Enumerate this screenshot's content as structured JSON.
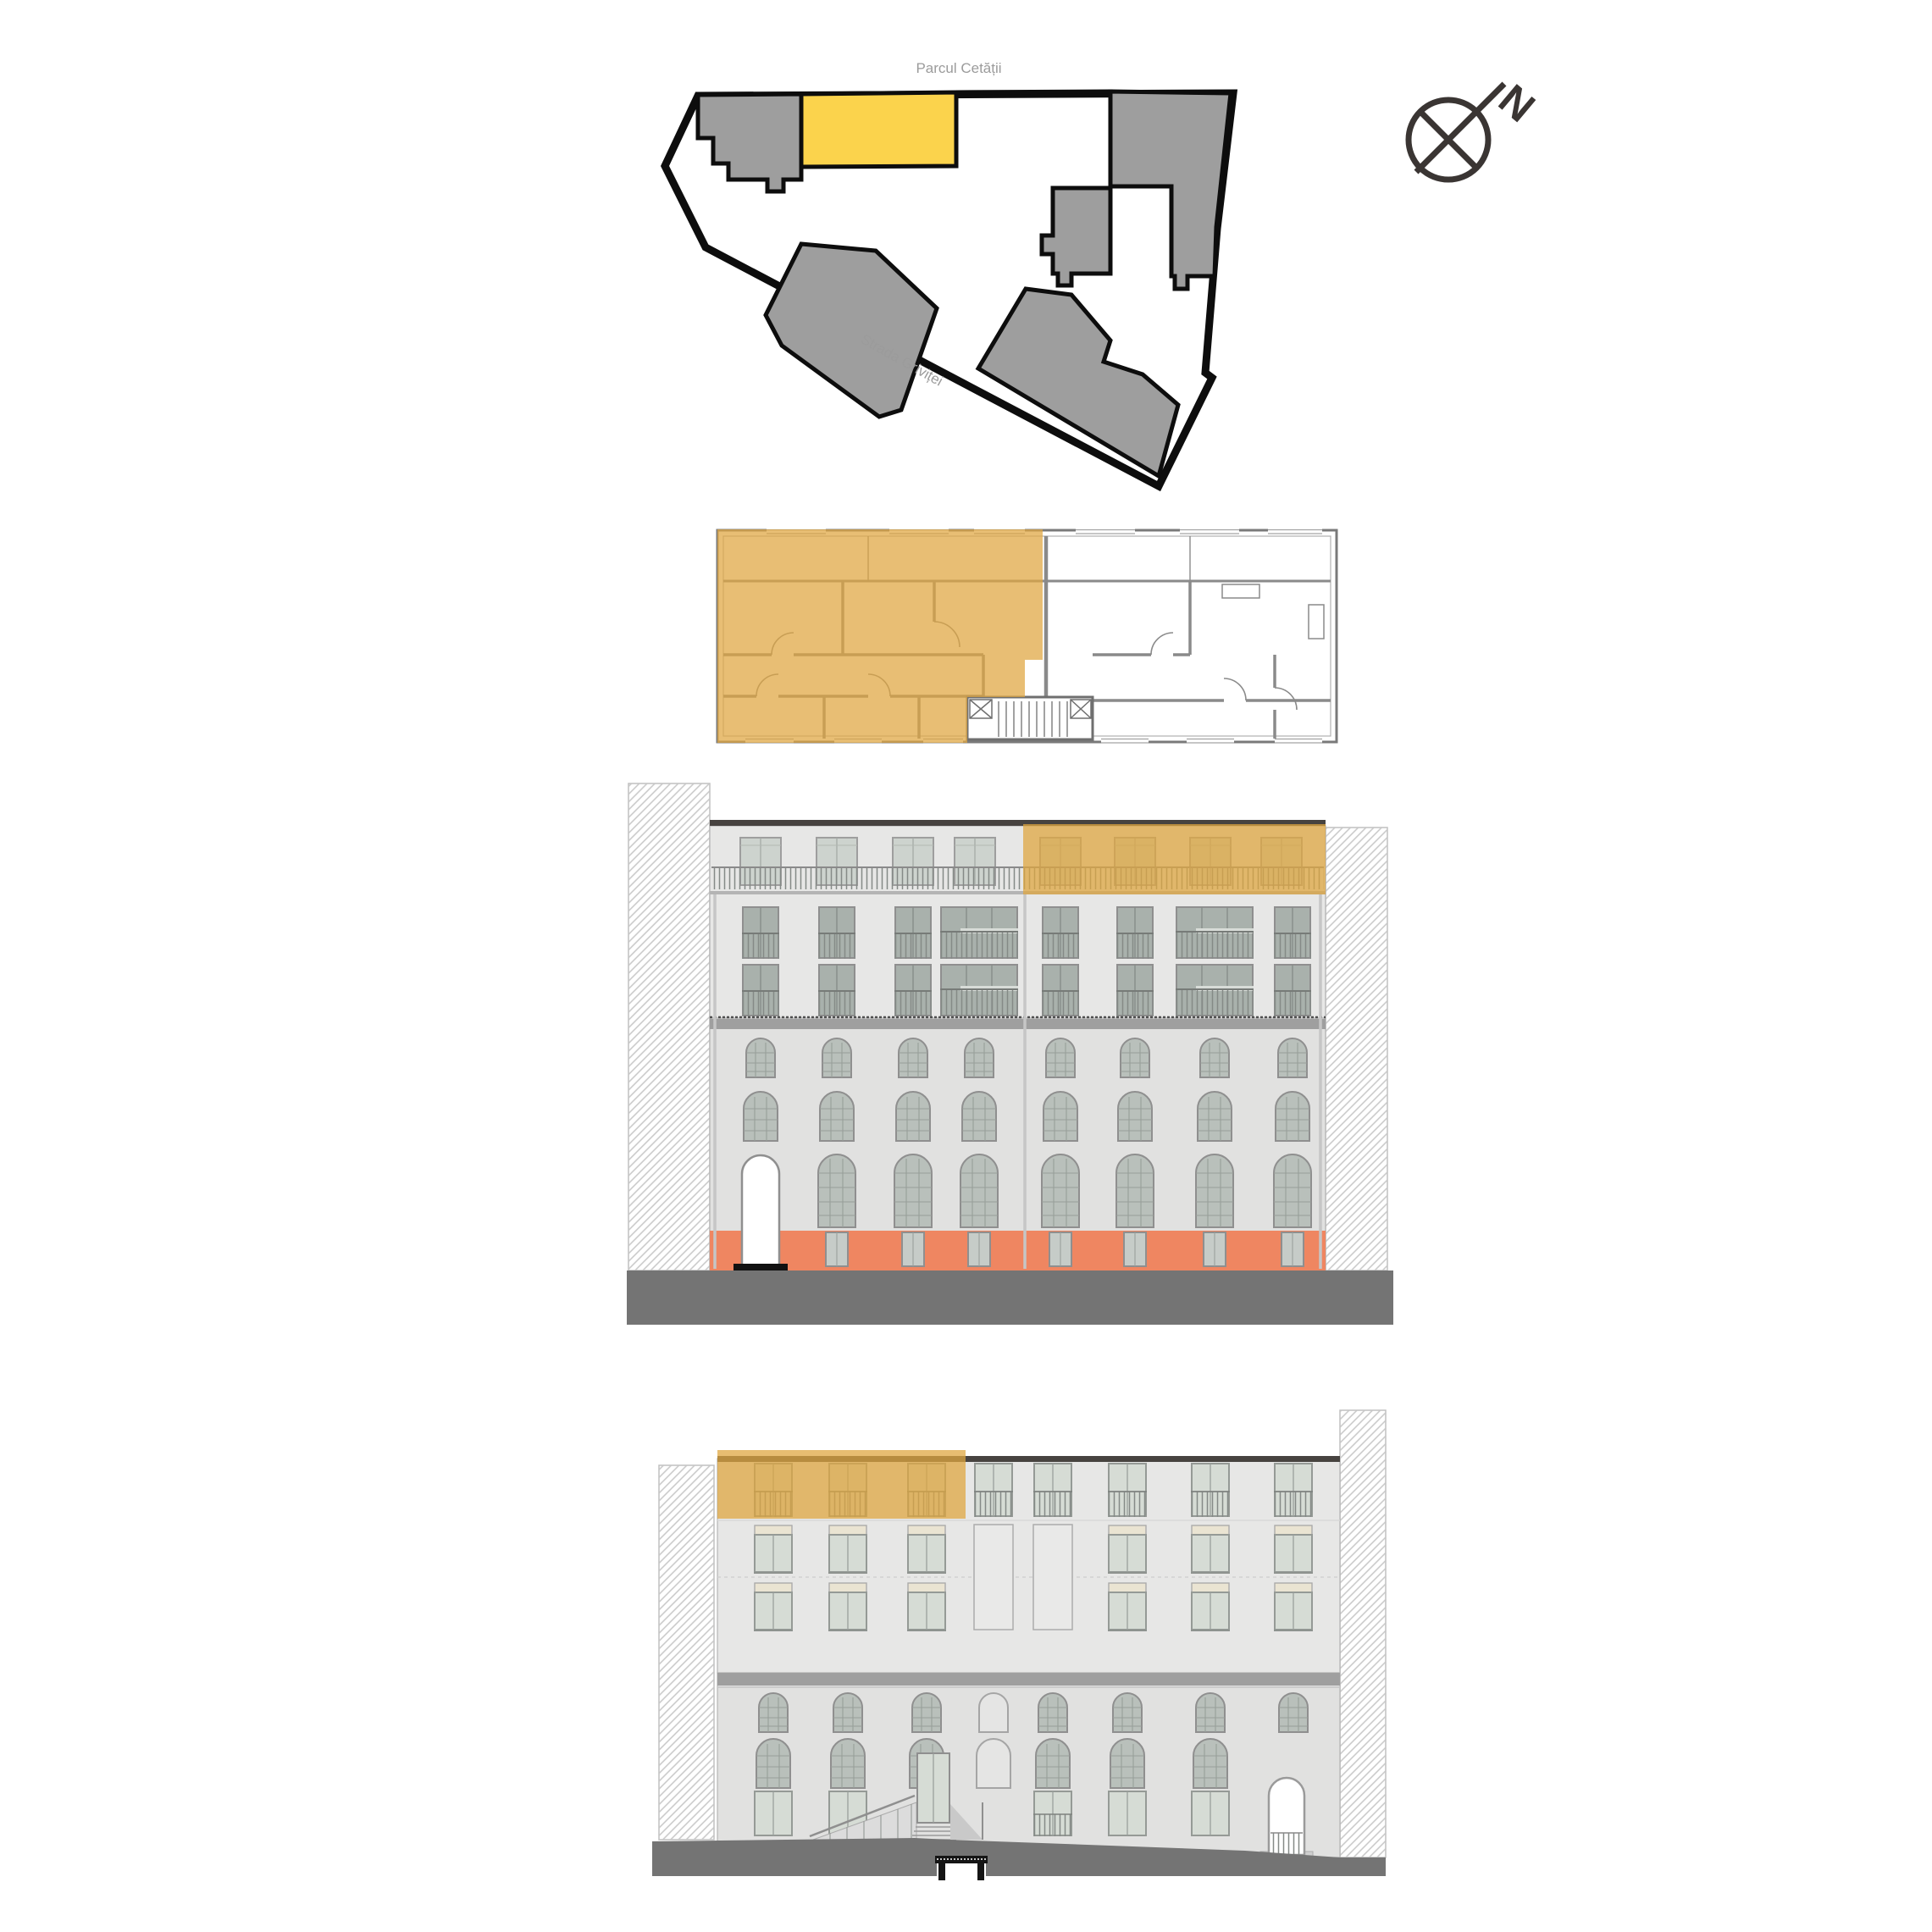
{
  "labels": {
    "park": "Parcul Cetății",
    "street": "Strada Griviței",
    "north": "N"
  },
  "colors": {
    "highlight_yellow": "#FBD34C",
    "overlay_ochre": "#DFA640",
    "building_gray": "#9E9E9E",
    "boundary_black": "#0D0D0D",
    "label_gray": "#9B9B9B",
    "facade_upper": "#E7E7E6",
    "facade_lower": "#E1E1E0",
    "terrain_orange": "#EF8661",
    "ground_gray": "#747474",
    "cornice_gray": "#9F9F9F",
    "roof_dark": "#474340",
    "compass_dark": "#3A3533"
  }
}
